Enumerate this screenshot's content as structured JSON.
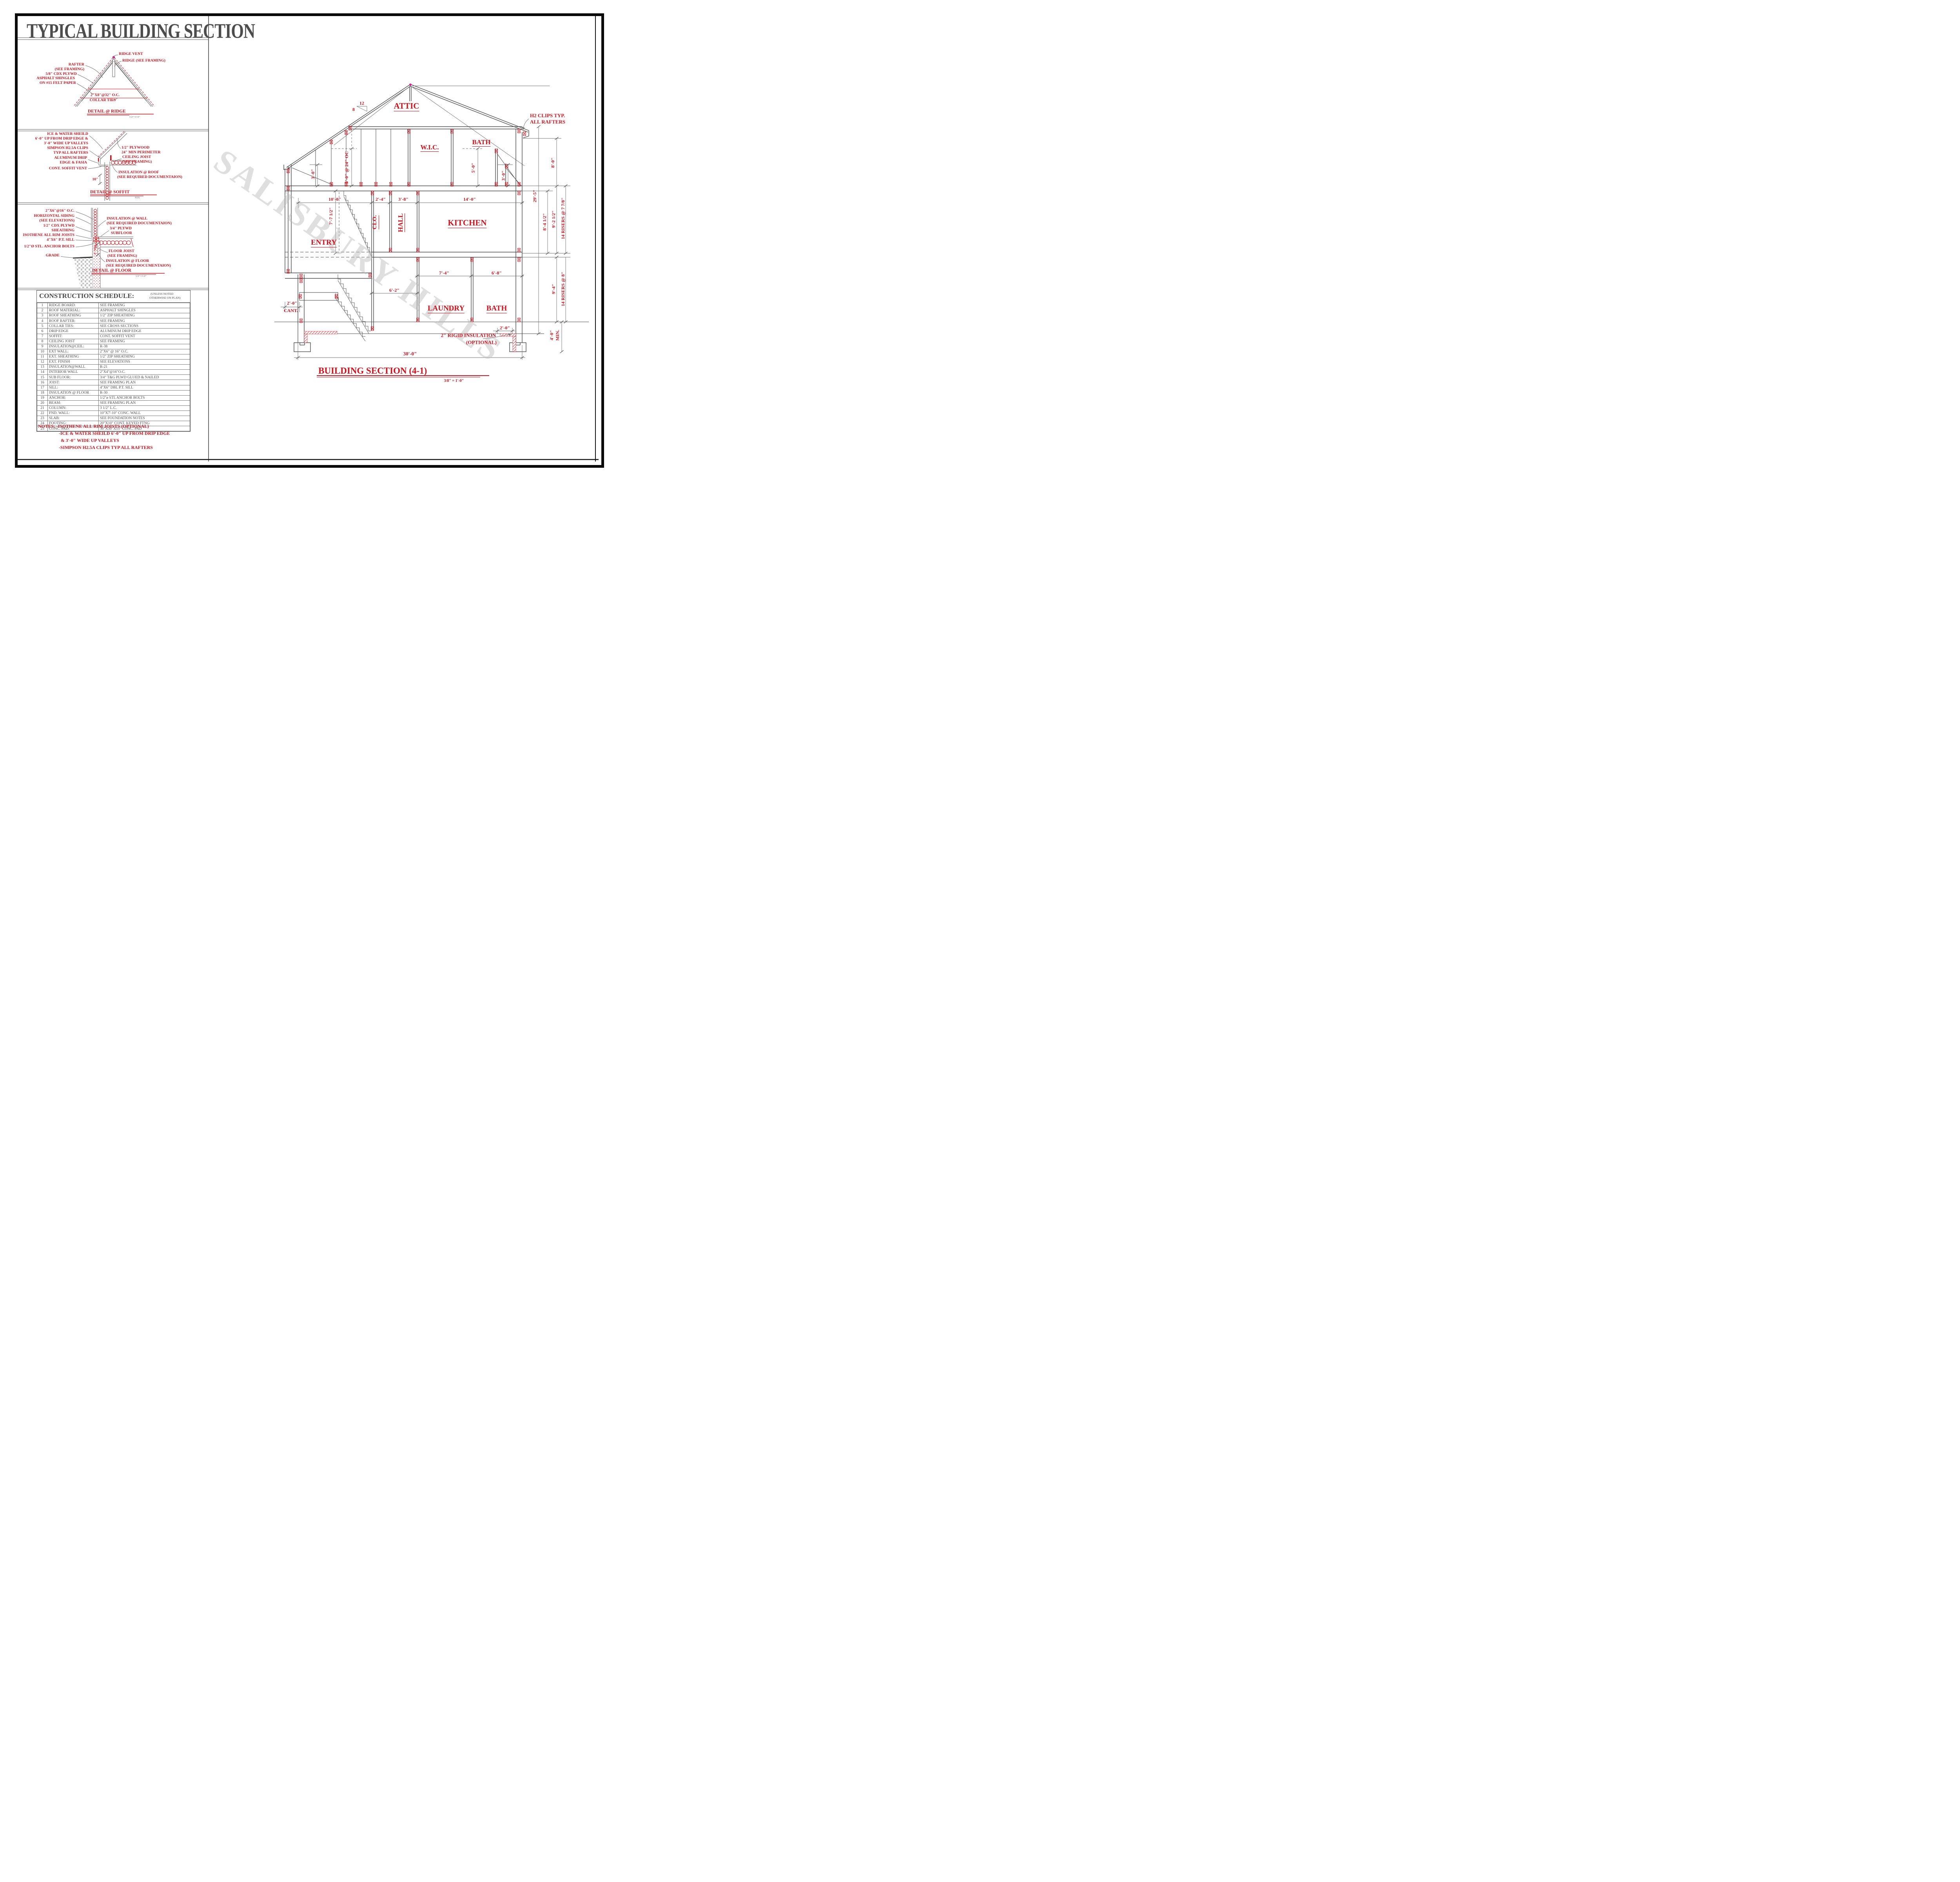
{
  "sheet": {
    "title": "TYPICAL BUILDING SECTION",
    "watermark": "SALISBURY HILLS"
  },
  "ridge_detail": {
    "title": "DETAIL @ RIDGE",
    "scale": "1/2\"=1'-0\"",
    "labels": {
      "ridge_vent": "RIDGE VENT",
      "ridge_framing": "RIDGE (SEE FRAMING)",
      "rafter_1": "RAFTER",
      "rafter_2": "(SEE FRAMING)",
      "plywd": "5/8\" CDX PLYWD",
      "shingles": "ASPHALT SHINGLES",
      "felt": "ON #15 FELT PAPER",
      "collar_1": "2\"X8\"@32\" O.C.",
      "collar_2": "COLLAR TIES"
    }
  },
  "soffit_detail": {
    "title": "DETAIL @ SOFFIT",
    "scale": "NTS",
    "labels": {
      "iws_1": "ICE & WATER SHEILD",
      "iws_2": "6'-0\" UP FROM DRIP EDGE &",
      "iws_3": "3'-0\" WIDE UP VALLEYS",
      "simpson_1": "SIMPSON H2.5A CLIPS",
      "simpson_2": "TYP ALL RAFTERS",
      "drip_1": "ALUMINUM DRIP",
      "drip_2": "EDGE & FASIA",
      "vent": "CONT. SOFFIT VENT",
      "ten_inch": "10\"",
      "ply_1": "1/2\" PLYWOOD",
      "ply_2": "24\" MIN PERIMETER",
      "joist_1": "CEILING JOIST",
      "joist_2": "(SEE FRAMING)",
      "ins_1": "INSULATION @ ROOF",
      "ins_2": "(SEE REQUIRED DOCUMENTAION)"
    }
  },
  "floor_detail": {
    "title": "DETAIL @ FLOOR",
    "scale": "1/2\"=1'-0\"",
    "labels": {
      "oc16": "2\"X6\"@16\" O.C.",
      "siding_1": "HORIZONTAL SIDING",
      "siding_2": "(SEE ELEVATIONS)",
      "cdx_1": "1/2\" CDX PLYWD",
      "cdx_2": "SHEATHING",
      "isothene": "ISOTHENE ALL RIM JOISTS",
      "sill": "4\"X6\" P.T. SILL",
      "anchor": "1/2\"Ø STL. ANCHOR BOLTS",
      "grade": "GRADE",
      "eight_min": "8\" MIN.",
      "inswall_1": "INSULATION @ WALL",
      "inswall_2": "(SEE REQUIRED DOCUMENTAION)",
      "subfloor_1": "3/4\" PLYWD",
      "subfloor_2": "SUBFLOOR",
      "joist_1": "FLOOR JOIST",
      "joist_2": "(SEE FRAMING)",
      "insfloor_1": "INSULATION @ FLOOR",
      "insfloor_2": "(SEE REQUIRED DOCUMENTAION)"
    }
  },
  "schedule": {
    "title": "CONSTRUCTION SCHEDULE:",
    "qualifier_1": "(UNLESS NOTED",
    "qualifier_2": "OTHERWISE ON PLAN)",
    "rows": [
      {
        "num": "1",
        "item": "RIDGE BOARD:",
        "spec": "SEE FRAMING"
      },
      {
        "num": "2",
        "item": "ROOF MATERIAL:",
        "spec": "ASPHALT SHINGLES"
      },
      {
        "num": "3",
        "item": "ROOF SHEATHING",
        "spec": "1/2\" ZIP SHEATHING"
      },
      {
        "num": "4",
        "item": "ROOF RAFTER:",
        "spec": "SEE FRAMING"
      },
      {
        "num": "5",
        "item": "COLLAR TIES:",
        "spec": "SEE CROSS SECTIONS"
      },
      {
        "num": "6",
        "item": "DRIP EDGE",
        "spec": "ALUMINUM DRIP EDGE"
      },
      {
        "num": "7",
        "item": "SOFFIT:",
        "spec": "CONT. SOFFIT VENT"
      },
      {
        "num": "8",
        "item": "CEILING JOIST",
        "spec": "SEE FRAMING"
      },
      {
        "num": "9",
        "item": "INSULATION@CEIL:",
        "spec": "R-38"
      },
      {
        "num": "10",
        "item": "EXT WALL:",
        "spec": "2\"X6\" @ 16\" O.C."
      },
      {
        "num": "11",
        "item": "EXT. SHEATHING",
        "spec": "1/2\" ZIP SHEATHING"
      },
      {
        "num": "12",
        "item": "EXT. FINISH",
        "spec": "SEE ELEVATIONS"
      },
      {
        "num": "13",
        "item": "INSULATION@WALL",
        "spec": "R-21"
      },
      {
        "num": "14",
        "item": "INTERIOR WALL",
        "spec": "2\"X4\"@16\"O.C."
      },
      {
        "num": "15",
        "item": "SUB FLOOR:",
        "spec": "3/4\" T&G PLWD GLUED & NAILED"
      },
      {
        "num": "16",
        "item": "JOIST:",
        "spec": "SEE FRAMING PLAN"
      },
      {
        "num": "17",
        "item": "SILL:",
        "spec": "4\"X6\" DBL P.T. SILL"
      },
      {
        "num": "18",
        "item": "INSULATION @ FLOOR",
        "spec": "R-30"
      },
      {
        "num": "19",
        "item": "ANCHOR:",
        "spec": "1/2\"ø STL ANCHOR BOLTS"
      },
      {
        "num": "20",
        "item": "BEAM:",
        "spec": "SEE FRAMING PLAN"
      },
      {
        "num": "21",
        "item": "COLUMN:",
        "spec": "3 1/2\" L.C."
      },
      {
        "num": "22",
        "item": "FND. WALL:",
        "spec": "10\"X7'-10\" CONC. WALL"
      },
      {
        "num": "23",
        "item": "SLAB:",
        "spec": "SEE FOUNDATION NOTES"
      },
      {
        "num": "24",
        "item": "FOOTING:",
        "spec": "20\"X10\" CONT. KEYED FTNG"
      },
      {
        "num": "25",
        "item": "CONC. PAD:",
        "spec": "30\"X30\"X15\" CONC. PAD"
      }
    ]
  },
  "notes": {
    "line1": "NOTES: -ISOTHENE ALL RIM JOISTS (OPTIONAL)",
    "line2": "-ICE & WATER SHEILD 6'-0\" UP FROM DRIP EDGE",
    "line3": "& 3'-0\" WIDE UP VALLEYS",
    "line4": "-SIMPSON H2.5A CLIPS TYP ALL RAFTERS"
  },
  "section": {
    "title": "BUILDING SECTION (4-1)",
    "scale": "3/8\" = 1'-0\"",
    "slope_rise": "8",
    "slope_run": "12",
    "rooms": {
      "attic": "ATTIC",
      "wic": "W.I.C.",
      "bath_upper": "BATH",
      "clo": "CLO.",
      "hall": "HALL",
      "kitchen": "KITCHEN",
      "entry": "ENTRY",
      "laundry": "LAUNDRY",
      "bath_lower": "BATH"
    },
    "labels": {
      "h2_1": "H2 CLIPS TYP.",
      "h2_2": "ALL RAFTERS",
      "rigid_1": "2\" RIGID INSULATION",
      "rigid_2": "(OPTIONAL)",
      "cant_1": "2'-0\"",
      "cant_2": "CANT."
    },
    "dims": {
      "w_overall": "30'-0\"",
      "w_10": "10'-0\"",
      "w_2_4": "2'-4\"",
      "w_3_8": "3'-8\"",
      "w_14": "14'-0\"",
      "w_6_2": "6'-2\"",
      "w_7_4": "7'-4\"",
      "w_6_8": "6'-8\"",
      "h_8": "8'-0\"",
      "h_29_5": "29'-5\"",
      "h_8_4": "8'-4 1/2\"",
      "h_9_2": "9'-2 1/2\"",
      "r14_77": "14 RISERS @ 7 7/8\"",
      "h_9_4": "9'-4\"",
      "r14_8": "14 RISERS @ 8\"",
      "h_4_0": "4'-0\"",
      "min": "MIN.",
      "k_5_24": "5'-0\" @ 24\" OC",
      "k_3l": "3'-0\"",
      "h_7_7": "7'-7 1/2\"",
      "k_5r": "5'-0\"",
      "k_3r": "3'-0\"",
      "rigid_2ft": "2'-0\""
    }
  }
}
